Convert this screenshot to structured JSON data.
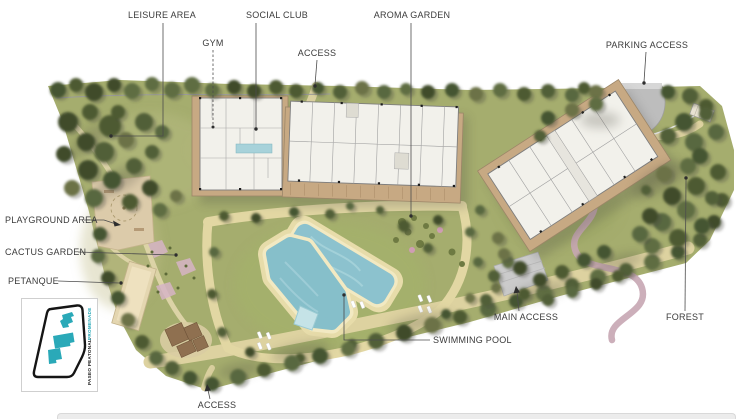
{
  "title": "Residential masterplan site plan",
  "labels": {
    "leisure_area": "LEISURE AREA",
    "social_club": "SOCIAL CLUB",
    "gym": "GYM",
    "access_top": "ACCESS",
    "aroma_garden": "AROMA GARDEN",
    "parking_access": "PARKING ACCESS",
    "playground_area": "PLAYGROUND AREA",
    "cactus_garden": "CACTUS GARDEN",
    "petanque": "PETANQUE",
    "swimming_pool": "SWIMMING POOL",
    "main_access": "MAIN ACCESS",
    "forest": "FOREST",
    "access_bottom": "ACCESS"
  },
  "legend": {
    "paseo_peatonal": "PASEO PEATONAL.",
    "promenade": "PROMENADE",
    "accent_color": "#2aa9b8"
  },
  "colors": {
    "label_text": "#3b3b3b",
    "lawn": "#a5ad6e",
    "tree_dark": "#4d5a33",
    "path_tan": "#e2d7a3",
    "terrace_brown": "#c7a983",
    "building_white": "#f2f1eb",
    "pool_water": "#8cc2ce",
    "parking_gray": "#bdbdbd",
    "forest_path_mauve": "#c6a6b2",
    "legend_accent": "#2aa9b8"
  }
}
